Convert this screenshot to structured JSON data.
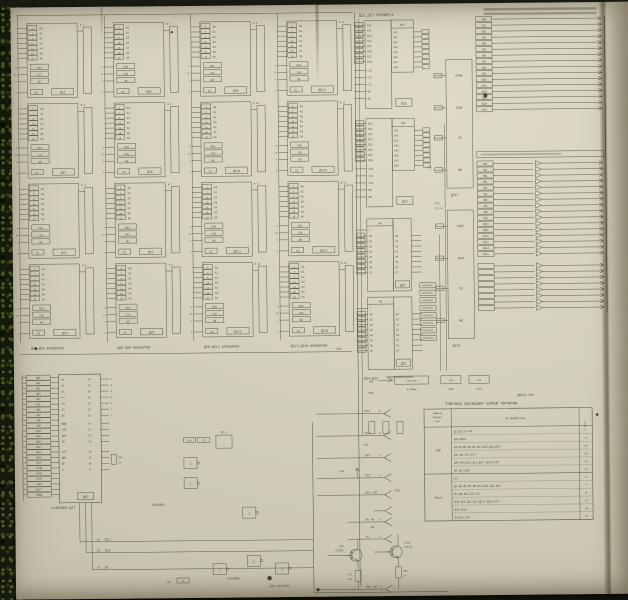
{
  "palette": {
    "photo_bg": "#14150e",
    "moss_green": "#2c3816",
    "paper": "#d6d1c0",
    "ink": "#49473a",
    "speck": "#23211b"
  },
  "memory_array": {
    "pin_labels": [
      "А0",
      "А1",
      "А2",
      "А3",
      "А4",
      "А5",
      "А6"
    ],
    "pin_numbers": [
      "5",
      "7",
      "6",
      "12",
      "11",
      "10",
      "13"
    ],
    "ctrl_labels": [
      "RAS",
      "CAS",
      "WE"
    ],
    "ctrl_numbers": [
      "4",
      "15",
      "3"
    ],
    "di_label": "DI",
    "di_number": "2",
    "plus5": "+5В",
    "groups": [
      {
        "caption": "Д51-Д54 КР565РУ6Г",
        "chips": [
          "Д51",
          "Д52",
          "Д53",
          "Д54"
        ],
        "bus": [
          "№ 1",
          "№ 2",
          "№ 3",
          "№ 4"
        ]
      },
      {
        "caption": "Д55-Д58 КР565РУ6Г",
        "chips": [
          "Д55",
          "Д56",
          "Д57",
          "Д58"
        ],
        "bus": [
          "№ 5",
          "№ 6",
          "№ 7",
          "№ 8"
        ]
      },
      {
        "caption": "Д59-Д512 КР565РУ6Г",
        "chips": [
          "Д59",
          "Д510",
          "Д511",
          "Д512"
        ],
        "bus": [
          "№ 9",
          "№ 10",
          "№ 11",
          "№ 12"
        ]
      },
      {
        "caption": "Д513-Д516 КР565РУ6Г",
        "chips": [
          "Д513",
          "Д514",
          "Д515",
          "Д516"
        ],
        "bus": [
          "№ 13",
          "№ 14",
          "№ 15",
          "№ 16"
        ]
      }
    ]
  },
  "ir12": {
    "title": "Д22,Д23 К589ИР12",
    "blocks": [
      "Д22",
      "Д23"
    ],
    "func_label": "INP",
    "left_pins": [
      "DI1",
      "DI2",
      "DI3",
      "DI4",
      "DI5",
      "DI6",
      "DI7",
      "DI8"
    ],
    "ctrl_pins": [
      "CLR",
      "CS1",
      "CS2",
      "MD",
      "EW"
    ],
    "right_pins": [
      "DO1",
      "DO2",
      "DO3",
      "DO4",
      "DO5",
      "DO6",
      "DO7",
      "DO8"
    ]
  },
  "registers": {
    "caption": "Д24,Д25",
    "func_label": "RG",
    "blocks": [
      "Д24",
      "Д25"
    ],
    "clock_pin": "С",
    "left_pins": [
      "D0",
      "D1",
      "D2",
      "D3",
      "D4",
      "D5",
      "D6",
      "D7"
    ],
    "right_pins": [
      "Q0",
      "Q1",
      "Q2",
      "Q3",
      "Q4",
      "Q5",
      "Q6",
      "Q7"
    ]
  },
  "right_io": {
    "blocks": [
      "Д517",
      "Д518"
    ],
    "ctrl_rows": [
      "SYNC",
      "DIN",
      "CE",
      "WE"
    ],
    "misc_labels": [
      "ХТ8",
      "РС-Р4",
      "+5В"
    ],
    "upper_signals": [
      "АД0",
      "АД1",
      "АД2",
      "АД3",
      "АД4",
      "АД5",
      "АД6",
      "АД7",
      "АД8",
      "АД9",
      "АД10",
      "АД11",
      "АД12",
      "АД13",
      "АД14",
      "АД15"
    ],
    "lower_signals": [
      "РД0",
      "РД1",
      "РД2",
      "РД3",
      "РД4",
      "РД5",
      "РД6",
      "РД7",
      "РД8",
      "РД9",
      "РД10",
      "РД11",
      "РД12",
      "РД13",
      "РД14",
      "РД15"
    ]
  },
  "cpu": {
    "name": "Д47",
    "caption": "К1801ВМ1-Д27",
    "left_pins": [
      "АД0",
      "АД1",
      "АД2",
      "АД3",
      "АД4",
      "АД5",
      "АД6",
      "АД7",
      "АД8",
      "АД9",
      "АД10",
      "АД11",
      "АД12",
      "АД13",
      "АД14",
      "АД15",
      "ВИР",
      "КРПД",
      "КРП5",
      "СИНХ",
      "ДИН",
      "ДОУТ",
      "ВЫВД"
    ],
    "addr_pins": [
      "А0",
      "А1",
      "А2",
      "А3",
      "А4",
      "А5",
      "А6"
    ],
    "addr_numbers": [
      "40",
      "49",
      "28",
      "22",
      "23",
      "26",
      "25"
    ],
    "addr_conn": [
      "1",
      "2",
      "3",
      "4",
      "5",
      "6",
      "7"
    ],
    "ctrl_rows": [
      {
        "label": "ВЫВ",
        "pin": "34"
      },
      {
        "label": "СИА",
        "pin": "33"
      },
      {
        "label": "ВИР",
        "pin": "38"
      },
      {
        "label": "ОЕ",
        "pin": "42"
      }
    ],
    "lower_rows": [
      {
        "label": "СПЛ",
        "pin": "36"
      },
      {
        "label": "ДМГ",
        "pin": "18"
      },
      {
        "label": "ВС",
        "pin": "30"
      },
      {
        "label": "Е",
        "pin": "37"
      }
    ],
    "resistor": {
      "name": "R50",
      "value": "1к"
    },
    "bottom_signals": [
      {
        "pin": "15",
        "label": "ТШ/1"
      },
      {
        "pin": "19",
        "label": "ТШ/2"
      },
      {
        "pin": "47",
        "label": "ТШ"
      }
    ]
  },
  "logic": {
    "captions": [
      "К155ЛН3",
      "К155ЛН3",
      "Д41 К155ЛН3"
    ],
    "parts": [
      {
        "name": "Д7.2"
      },
      {
        "name": "R16"
      },
      {
        "name": "С8"
      }
    ],
    "resistor_value": "1к",
    "power": "+5В"
  },
  "xt5": {
    "name": "ХТ5",
    "power": "+5В",
    "rows": [
      {
        "label": "РЕЗ",
        "pin": "6"
      },
      {
        "label": "РЕЗ",
        "pin": "3"
      },
      {
        "label": "РЕЗ",
        "pin": "4"
      },
      {
        "label": "РЕЗ",
        "pin": "2"
      },
      {
        "label": "Вкл.чб2",
        "pin": ""
      },
      {
        "label": "Вн.чб",
        "pin": "3"
      },
      {
        "label": "Бс",
        "pin": "4"
      },
      {
        "label": "Вкл.чб1",
        "pin": "5"
      }
    ]
  },
  "transistors": [
    {
      "name": "VT9",
      "type": "КТ315Г"
    },
    {
      "name": "VT10",
      "type": "КТ315Г"
    }
  ],
  "resistors": [
    {
      "name": "R57",
      "value": "15к"
    },
    {
      "name": "R58",
      "value": "1к"
    }
  ],
  "power_rail": {
    "label": "+5В",
    "common": "Общ.",
    "caps": [
      {
        "name": "С10…С40",
        "value": "0,068мк"
      },
      {
        "name": "С49",
        "value": "47мк"
      },
      {
        "name": "С50",
        "value": "43мк"
      }
    ]
  },
  "power_table": {
    "doc_code": "ДМ2ЧГ.ЧБР",
    "title": "Таблица разводки цепей питания",
    "headers": {
      "voltage_lines": [
        "Номинал",
        "напряже-",
        "ния"
      ],
      "device": "Устройство",
      "contact": "Конт."
    },
    "groups": [
      {
        "voltage": "+5В",
        "rows": [
          {
            "device": "Д2,Д11,Е4-Е9",
            "contact": "1"
          },
          {
            "device": "Д44-Д516",
            "contact": "8"
          },
          {
            "device": "Д1,Д3,Д5-Д7,Д9-Д14,Д15,Д20,Д40",
            "contact": "14"
          },
          {
            "device": "Д17,Д8,ХТ1,ХТ2",
            "contact": "16"
          },
          {
            "device": "Д45-Д48,Д22-Д25,Д517-Д518,ХТ8",
            "contact": "24"
          },
          {
            "device": "Д4,Д14,Д19",
            "contact": "42"
          }
        ]
      },
      {
        "voltage": "Общий",
        "rows": [
          {
            "device": "Е3",
            "contact": "3"
          },
          {
            "device": "Д1,Д3,Д5-Д7,Д9-Д14,Д19,Д20,Д44",
            "contact": "7"
          },
          {
            "device": "Д7,Д8,Д12,ХТ1,ХТ2",
            "contact": "8"
          },
          {
            "device": "Д45-Д48,Д22-Д25,Д517-Д518,ХТ8",
            "contact": "12"
          },
          {
            "device": "Д51-Д516",
            "contact": "16"
          },
          {
            "device": "Д4,Д14,Д19",
            "contact": "17"
          }
        ]
      }
    ]
  }
}
